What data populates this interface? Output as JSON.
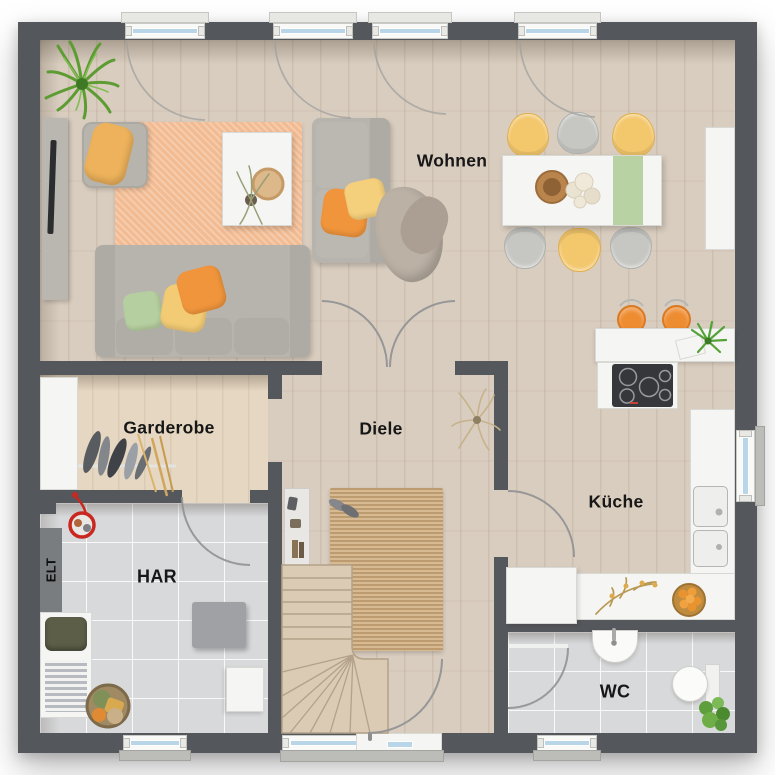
{
  "rooms": {
    "wohnen": {
      "label": "Wohnen"
    },
    "garderobe": {
      "label": "Garderobe"
    },
    "diele": {
      "label": "Diele"
    },
    "kueche": {
      "label": "Küche"
    },
    "har": {
      "label": "HAR"
    },
    "elt": {
      "label": "ELT"
    },
    "wc": {
      "label": "WC"
    }
  },
  "colors": {
    "wall": "#54575b",
    "wood_floor": "#d9cdbf",
    "garderobe_floor": "#e5d7c1",
    "tile_floor": "#d8d9db",
    "window_glass": "#b9d6e8",
    "accent_orange": "#ee8c31",
    "accent_yellow": "#f3c76c",
    "accent_green": "#b8d2a4",
    "rug_living": "#f2bb92",
    "rug_jute": "#cfad80",
    "stair_wood": "#dbcbb4"
  }
}
